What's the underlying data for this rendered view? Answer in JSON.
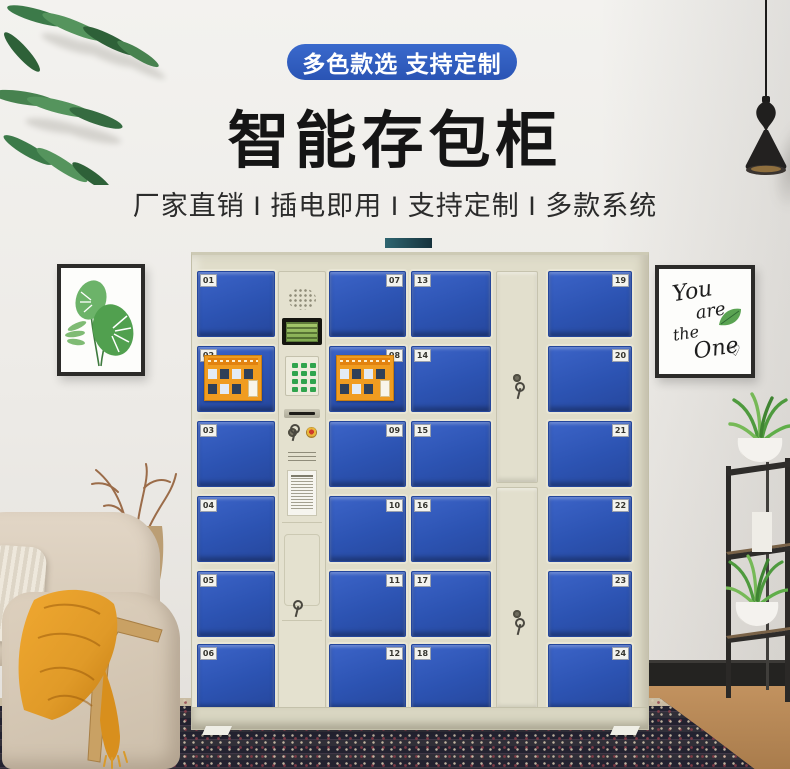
{
  "banner": {
    "ribbon_label": "多色款选 支持定制",
    "title": "智能存包柜",
    "subtitle": "厂家直销 I 插电即用 I 支持定制 I 多款系统"
  },
  "colors": {
    "ribbon_blue": "#2f5ebe",
    "divider_teal_start": "#2e6570",
    "divider_teal_end": "#16323c",
    "door_blue": "#2c53b0",
    "cabinet_beige": "#e0ddca",
    "sticker_orange": "#f09c20",
    "blanket_mustard": "#e09a28"
  },
  "locker": {
    "columns": [
      {
        "label_side": "left",
        "doors": [
          "01",
          "02",
          "03",
          "04",
          "05",
          "06"
        ]
      },
      {
        "label_side": "right",
        "doors": [
          "07",
          "08",
          "09",
          "10",
          "11",
          "12"
        ]
      },
      {
        "label_side": "left",
        "doors": [
          "13",
          "14",
          "15",
          "16",
          "17",
          "18"
        ]
      },
      {
        "label_side": "right",
        "doors": [
          "19",
          "20",
          "21",
          "22",
          "23",
          "24"
        ]
      }
    ],
    "sticker_doors": [
      "02",
      "08"
    ]
  },
  "artwork": {
    "lines": [
      "You",
      "are",
      "the",
      "One"
    ],
    "heart": "♡"
  },
  "icons": {
    "speaker": "speaker-grille",
    "screen": "lcd-display",
    "keypad": "numeric-keypad",
    "slot": "ticket-slot",
    "lock": "key-lock",
    "emblem": "round-badge"
  }
}
